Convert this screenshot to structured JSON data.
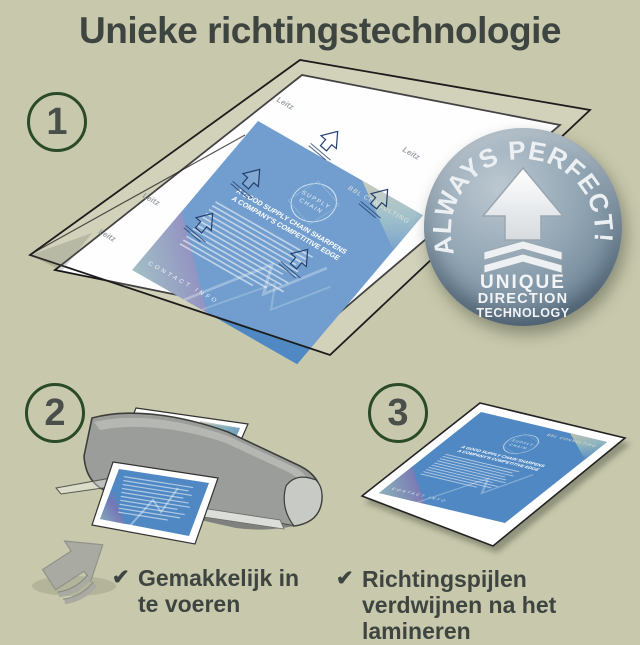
{
  "page": {
    "title": "Unieke richtingstechnologie"
  },
  "steps": {
    "one": "1",
    "two": "2",
    "three": "3"
  },
  "badge": {
    "arc_text": "ALWAYS PERFECT!",
    "line1": "UNIQUE",
    "line2": "DIRECTION",
    "line3": "TECHNOLOGY"
  },
  "document": {
    "brand": "BBL CONSULTING",
    "logo_line1": "SUPPLY",
    "logo_line2": "CHAIN",
    "headline_line1": "A GOOD SUPPLY CHAIN SHARPENS",
    "headline_line2": "A COMPANY'S COMPETITIVE EDGE",
    "footer": "CONTACT INFO",
    "watermark": "Leitz"
  },
  "checklist": {
    "check_glyph": "✔",
    "item1": "Gemakkelijk in te voeren",
    "item2": "Richtingspijlen verdwijnen na het lamineren"
  },
  "colors": {
    "background": "#c8c9ac",
    "accent_green": "#2b4a28",
    "text": "#3e4541",
    "document_blue": "#4f88c3",
    "badge_gray": "#8b9dac"
  }
}
